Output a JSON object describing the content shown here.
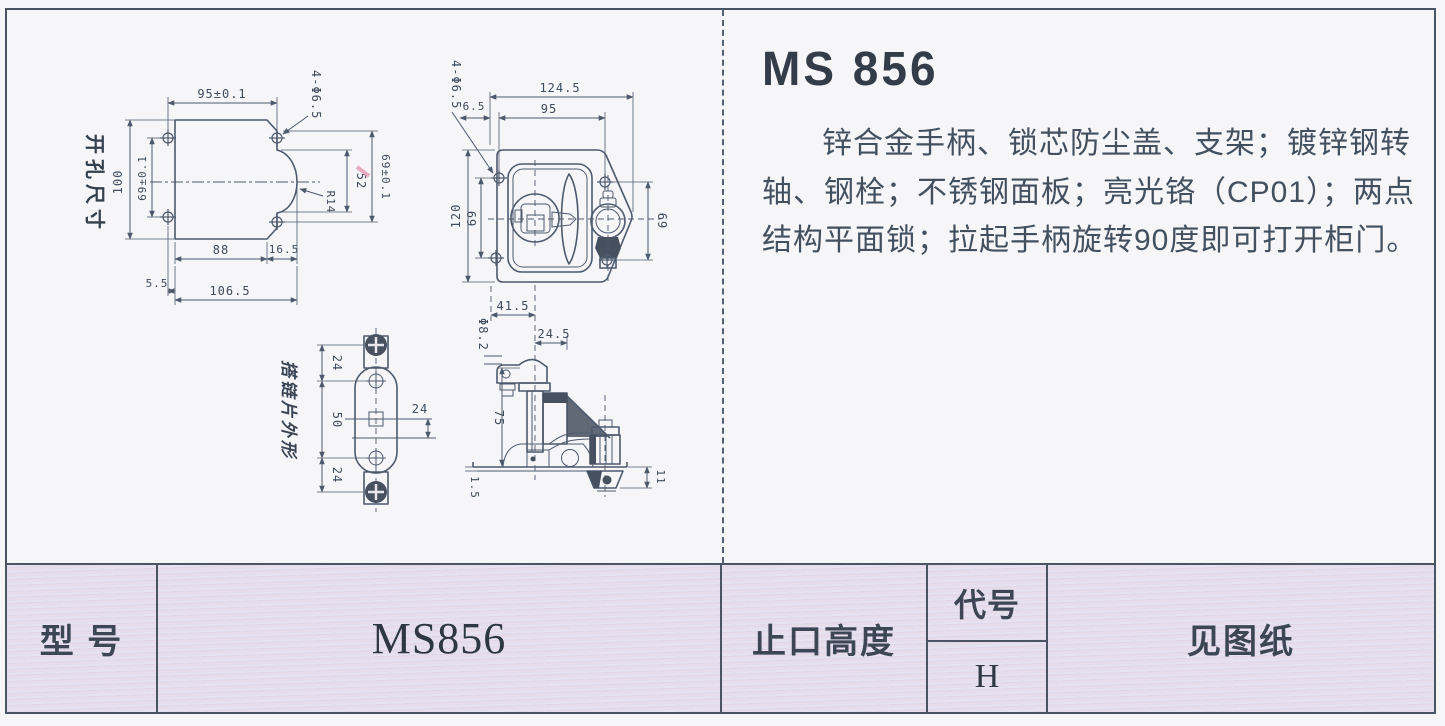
{
  "product": {
    "title": "MS 856",
    "description": "锌合金手柄、锁芯防尘盖、支架；镀锌钢转轴、钢栓；不锈钢面板；亮光铬（CP01）；两点结构平面锁；拉起手柄旋转90度即可打开柜门。"
  },
  "drawings": {
    "cutout_label": "开孔尺寸",
    "hasp_label": "搭链片外形",
    "d1": {
      "top_width": "95±0.1",
      "holes": "4-Φ6.5",
      "height": "100",
      "hole_pitch_v": "69±0.1",
      "notch_height": "52",
      "right_pitch_v": "69±0.1",
      "radius": "R14",
      "bottom_width": "88",
      "bottom_ext": "16.5",
      "edge_offset": "5.5",
      "total_width": "106.5"
    },
    "d2": {
      "holes": "4-Φ6.5",
      "hole_edge": "6.5",
      "total_width": "124.5",
      "hole_pitch_h": "95",
      "height": "120",
      "hole_pitch_v": "69",
      "right_pitch_v": "69",
      "handle_offset": "41.5",
      "cyl_offset": "24.5"
    },
    "d3": {
      "shaft_dia": "Φ8.2",
      "depth": "75",
      "panel_thickness": "1.5",
      "cam_drop": "11"
    },
    "d4": {
      "top_pitch": "24",
      "mid_pitch": "50",
      "bottom_pitch": "24",
      "width": "24"
    }
  },
  "table": {
    "model_label": "型 号",
    "model_value": "MS856",
    "height_label": "止口高度",
    "code_label": "代号",
    "code_value": "H",
    "drawing_note": "见图纸"
  },
  "colors": {
    "line": "#4d5a6e",
    "text": "#3f4c5c",
    "table_bg": "#e2ddee",
    "accent_mark": "#e49ab2"
  }
}
